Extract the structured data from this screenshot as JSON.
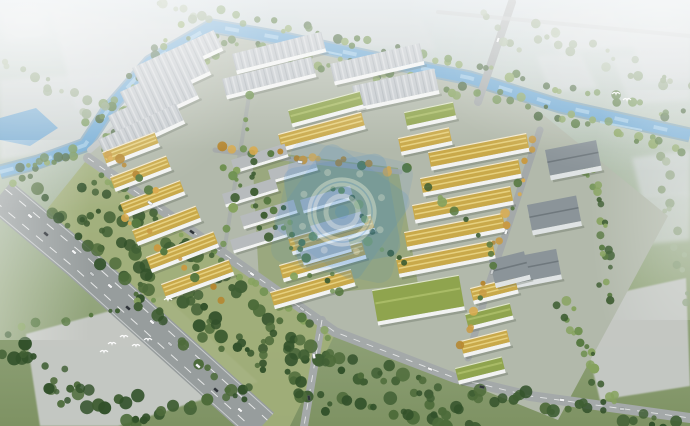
{
  "meta": {
    "description": "Bird's-eye architectural rendering of a large industrial park: rows of yellow-, green- and gray-roofed buildings bounded by tree-lined roads, a blue canal along the top, a wide highway at lower left, hazy vacant plots around the edges, flying birds, and a semi-transparent blue emblem watermark over the center."
  },
  "watermark": {
    "description": "semi-transparent blue circular emblem watermark",
    "color": "#2f7fd2",
    "light": "#d8e9f8",
    "cx": 342,
    "cy": 212,
    "rotate": -20,
    "opacity": 0.5
  },
  "palette": {
    "sky_top": "#ccd6db",
    "sky_mid": "#b2c0b0",
    "ground": "#8da272",
    "lawn": "#a2af7a",
    "park_base": "#b2b9ab",
    "villa_ground": "#9aa87e",
    "water": "#6ba6d1",
    "water_edge": "#4f86ae",
    "water_hi": "#a8d0ea",
    "road": "#a4a9a9",
    "road_light": "#bcc1c1",
    "highway": "#979d9d",
    "lane": "#eef0f0",
    "plot": "#d0d5d7",
    "pad": "#c7cac7",
    "wh_roof": "#c3c8cc",
    "wh_ridge": "#9aa2a8",
    "yl_roof": "#c9a94a",
    "yl_hi": "#e6d07f",
    "gr_roof": "#8fa44e",
    "gr_hi": "#a9bb66",
    "dk_roof": "#8b9499",
    "slab_roof": "#b7bbbd",
    "facade": "#f2f3f2",
    "facade_dk": "#dfe3e4",
    "shadow": "#4a5548",
    "bird": "#ffffff",
    "car_white": "#f4f5f5",
    "car_dark": "#2e3338",
    "car_gray": "#c9cdce",
    "tree_shades": {
      "mix": [
        "#3f5e33",
        "#567840",
        "#6f9150",
        "#86a25e"
      ],
      "dark": [
        "#32512a",
        "#3f5e33",
        "#4d6b3a"
      ],
      "autumn": [
        "#c89a43",
        "#b5862f",
        "#d9ab4f",
        "#567840"
      ],
      "hazy": [
        "#93a687",
        "#a3b496",
        "#8ba07c"
      ]
    }
  },
  "scene": {
    "plots": [
      {
        "p": [
          [
            52,
            10
          ],
          [
            222,
            30
          ],
          [
            252,
            94
          ],
          [
            76,
            110
          ]
        ],
        "o": 0.8,
        "soft": true
      },
      {
        "p": [
          [
            0,
            80
          ],
          [
            138,
            70
          ],
          [
            170,
            138
          ],
          [
            0,
            160
          ]
        ],
        "o": 0.75,
        "soft": true
      },
      {
        "p": [
          [
            0,
            8
          ],
          [
            36,
            4
          ],
          [
            50,
            36
          ],
          [
            6,
            42
          ]
        ],
        "o": 0.6,
        "soft": true
      },
      {
        "p": [
          [
            298,
            10
          ],
          [
            422,
            20
          ],
          [
            436,
            50
          ],
          [
            312,
            42
          ]
        ],
        "o": 0.55,
        "soft": true
      },
      {
        "p": [
          [
            532,
            14
          ],
          [
            610,
            10
          ],
          [
            638,
            46
          ],
          [
            558,
            52
          ]
        ],
        "o": 0.75,
        "soft": true
      },
      {
        "p": [
          [
            628,
            30
          ],
          [
            690,
            24
          ],
          [
            690,
            80
          ],
          [
            646,
            82
          ]
        ],
        "o": 0.7,
        "soft": true
      },
      {
        "p": [
          [
            536,
            56
          ],
          [
            580,
            53
          ],
          [
            598,
            88
          ],
          [
            550,
            91
          ]
        ],
        "o": 0.65,
        "soft": true
      },
      {
        "p": [
          [
            612,
            58
          ],
          [
            690,
            52
          ],
          [
            690,
            100
          ],
          [
            630,
            104
          ]
        ],
        "o": 0.6,
        "soft": true
      },
      {
        "p": [
          [
            632,
            158
          ],
          [
            690,
            150
          ],
          [
            690,
            196
          ],
          [
            642,
            200
          ]
        ],
        "o": 0.7,
        "soft": true
      },
      {
        "p": [
          [
            640,
            200
          ],
          [
            690,
            194
          ],
          [
            690,
            240
          ],
          [
            650,
            244
          ]
        ],
        "o": 0.6,
        "soft": true
      },
      {
        "p": [
          [
            576,
            302
          ],
          [
            686,
            278
          ],
          [
            690,
            386
          ],
          [
            600,
            400
          ]
        ],
        "o": 0.95,
        "pad": true
      },
      {
        "p": [
          [
            26,
            334
          ],
          [
            164,
            296
          ],
          [
            258,
            382
          ],
          [
            118,
            426
          ],
          [
            40,
            426
          ]
        ],
        "o": 0.95,
        "pad": true
      }
    ],
    "park": [
      [
        88,
        155
      ],
      [
        212,
        32
      ],
      [
        520,
        96
      ],
      [
        668,
        216
      ],
      [
        558,
        420
      ],
      [
        338,
        332
      ]
    ],
    "villa_zone": [
      [
        252,
        150
      ],
      [
        398,
        168
      ],
      [
        418,
        284
      ],
      [
        260,
        300
      ]
    ],
    "lawn": [
      [
        85,
        162
      ],
      [
        335,
        334
      ],
      [
        290,
        426
      ],
      [
        250,
        426
      ],
      [
        120,
        300
      ],
      [
        48,
        208
      ]
    ],
    "canal": {
      "d": "M0,172 L38,162 L85,145 L108,110 L150,62 L212,26 L280,38 L400,64 L470,78 L560,106 L690,135",
      "w": 11
    },
    "pond": [
      [
        0,
        118
      ],
      [
        36,
        108
      ],
      [
        58,
        128
      ],
      [
        30,
        146
      ],
      [
        0,
        140
      ]
    ],
    "sparkles": [
      [
        600,
        122,
        642,
        130
      ],
      [
        300,
        46,
        342,
        55
      ],
      [
        150,
        68,
        134,
        94
      ]
    ],
    "roads": [
      {
        "pts": [
          [
            90,
            150
          ],
          [
            218,
            38
          ]
        ],
        "w": 6,
        "c": "road_light"
      },
      {
        "pts": [
          [
            512,
            2
          ],
          [
            478,
            102
          ]
        ],
        "w": 8,
        "c": "road"
      },
      {
        "pts": [
          [
            438,
            12
          ],
          [
            690,
            36
          ]
        ],
        "w": 4,
        "c": "road_light",
        "o": 0.7
      },
      {
        "pts": [
          [
            88,
            158
          ],
          [
            335,
            332
          ],
          [
            455,
            378
          ],
          [
            530,
            396
          ],
          [
            690,
            418
          ]
        ],
        "w": 10,
        "c": "road",
        "dash": true
      },
      {
        "pts": [
          [
            322,
            320
          ],
          [
            304,
            426
          ]
        ],
        "w": 8,
        "c": "road",
        "dash": true
      },
      {
        "pts": [
          [
            540,
            130
          ],
          [
            487,
            290
          ],
          [
            468,
            358
          ]
        ],
        "w": 7,
        "c": "road"
      },
      {
        "pts": [
          [
            215,
            150
          ],
          [
            400,
            172
          ]
        ],
        "w": 5,
        "c": "road",
        "o": 0.9
      },
      {
        "pts": [
          [
            250,
            90
          ],
          [
            224,
            252
          ]
        ],
        "w": 4,
        "c": "road",
        "o": 0.7
      }
    ],
    "highway": {
      "pts": [
        [
          0,
          195
        ],
        [
          80,
          262
        ],
        [
          180,
          352
        ],
        [
          262,
          426
        ]
      ],
      "w": 36,
      "lanes": [
        [
          -5.4,
          5.9
        ],
        [
          5.4,
          -5.9
        ]
      ],
      "edges": [
        [
          -10.9,
          11.8
        ],
        [
          10.9,
          -11.8
        ]
      ]
    },
    "buildings": [
      [
        132,
        68,
        90,
        19,
        "wh",
        -25
      ],
      [
        120,
        92,
        90,
        19,
        "wh",
        -25
      ],
      [
        108,
        116,
        90,
        19,
        "wh",
        -25
      ],
      [
        98,
        140,
        86,
        18,
        "wh",
        -25
      ],
      [
        232,
        54,
        92,
        17,
        "wh",
        -14
      ],
      [
        222,
        79,
        92,
        17,
        "wh",
        -14
      ],
      [
        330,
        64,
        92,
        18,
        "wh",
        -13
      ],
      [
        352,
        86,
        84,
        22,
        "wh",
        -12
      ],
      [
        288,
        110,
        74,
        14,
        "gr",
        -15
      ],
      [
        278,
        134,
        86,
        14,
        "yl",
        -15
      ],
      [
        404,
        112,
        50,
        14,
        "gr",
        -12
      ],
      [
        398,
        138,
        52,
        14,
        "yl",
        -12
      ],
      [
        428,
        152,
        100,
        15,
        "yl",
        -11
      ],
      [
        420,
        178,
        100,
        15,
        "yl",
        -11
      ],
      [
        412,
        205,
        100,
        15,
        "yl",
        -11
      ],
      [
        404,
        232,
        100,
        15,
        "yl",
        -11
      ],
      [
        396,
        259,
        98,
        15,
        "yl",
        -11
      ],
      [
        545,
        150,
        52,
        26,
        "dk",
        -11
      ],
      [
        527,
        205,
        50,
        26,
        "dk",
        -11
      ],
      [
        509,
        258,
        48,
        26,
        "dk",
        -11
      ],
      [
        288,
        238,
        86,
        14,
        "yl",
        -16
      ],
      [
        279,
        265,
        86,
        14,
        "yl",
        -16
      ],
      [
        270,
        292,
        84,
        14,
        "yl",
        -16
      ],
      [
        372,
        290,
        88,
        32,
        "gr",
        -10
      ],
      [
        470,
        288,
        46,
        13,
        "yl",
        -14
      ],
      [
        465,
        314,
        46,
        13,
        "gr",
        -14
      ],
      [
        460,
        341,
        48,
        13,
        "yl",
        -14
      ],
      [
        455,
        368,
        48,
        13,
        "gr",
        -14
      ],
      [
        489,
        260,
        36,
        24,
        "dk",
        -14
      ],
      [
        102,
        152,
        56,
        12,
        "yl",
        -21
      ],
      [
        110,
        177,
        60,
        12,
        "yl",
        -21
      ],
      [
        120,
        203,
        64,
        12,
        "yl",
        -21
      ],
      [
        132,
        230,
        68,
        13,
        "yl",
        -21
      ],
      [
        146,
        257,
        72,
        13,
        "yl",
        -21
      ],
      [
        161,
        284,
        72,
        13,
        "yl",
        -20
      ],
      [
        231,
        160,
        56,
        11,
        "slab",
        -17
      ],
      [
        268,
        170,
        48,
        11,
        "slab",
        -16
      ],
      [
        222,
        194,
        55,
        11,
        "slab",
        -17
      ],
      [
        240,
        216,
        56,
        11,
        "slab",
        -17
      ],
      [
        230,
        240,
        56,
        11,
        "slab",
        -17
      ],
      [
        300,
        200,
        52,
        11,
        "slab",
        -16
      ],
      [
        310,
        226,
        53,
        11,
        "slab",
        -16
      ],
      [
        300,
        252,
        50,
        11,
        "slab",
        -16
      ]
    ],
    "belts_under": [
      [
        210,
        38,
        460,
        90,
        14,
        30,
        "mix"
      ],
      [
        460,
        90,
        690,
        148,
        16,
        26,
        "mix"
      ],
      [
        196,
        40,
        96,
        150,
        16,
        24,
        "mix"
      ],
      [
        222,
        14,
        470,
        66,
        12,
        24,
        "mix"
      ],
      [
        470,
        64,
        690,
        118,
        12,
        20,
        "mix"
      ],
      [
        180,
        28,
        90,
        128,
        12,
        16,
        "mix"
      ],
      [
        80,
        150,
        10,
        178,
        14,
        14,
        "mix"
      ],
      [
        100,
        158,
        220,
        48,
        8,
        14,
        "mix"
      ],
      [
        92,
        170,
        332,
        340,
        10,
        30,
        "mix"
      ],
      [
        80,
        180,
        320,
        352,
        14,
        30,
        "dark"
      ],
      [
        70,
        210,
        300,
        390,
        30,
        55,
        "dark"
      ],
      [
        10,
        165,
        250,
        408,
        10,
        26,
        "dark"
      ],
      [
        0,
        350,
        150,
        426,
        34,
        34,
        "dark"
      ],
      [
        20,
        330,
        170,
        298,
        8,
        10,
        "mix"
      ],
      [
        120,
        420,
        260,
        386,
        10,
        12,
        "dark"
      ],
      [
        255,
        335,
        470,
        408,
        26,
        44,
        "dark"
      ],
      [
        300,
        400,
        480,
        426,
        16,
        20,
        "dark"
      ],
      [
        470,
        390,
        690,
        424,
        18,
        26,
        "dark"
      ],
      [
        560,
        300,
        610,
        400,
        16,
        20,
        "mix"
      ],
      [
        588,
        160,
        610,
        300,
        18,
        22,
        "mix"
      ],
      [
        660,
        150,
        688,
        300,
        12,
        14,
        "hazy"
      ],
      [
        0,
        66,
        150,
        134,
        20,
        18,
        "hazy"
      ],
      [
        150,
        6,
        215,
        20,
        10,
        8,
        "hazy"
      ],
      [
        520,
        26,
        690,
        92,
        24,
        20,
        "hazy"
      ],
      [
        480,
        8,
        520,
        60,
        10,
        6,
        "hazy"
      ]
    ],
    "belts_over": [
      [
        536,
        134,
        462,
        350,
        8,
        20,
        "autumn"
      ],
      [
        218,
        146,
        398,
        170,
        7,
        16,
        "autumn"
      ],
      [
        250,
        92,
        224,
        252,
        6,
        10,
        "mix"
      ],
      [
        228,
        160,
        330,
        285,
        34,
        30,
        "mix"
      ],
      [
        330,
        180,
        400,
        270,
        20,
        12,
        "mix"
      ],
      [
        118,
        210,
        225,
        300,
        9,
        12,
        "autumn"
      ],
      [
        100,
        150,
        160,
        195,
        8,
        8,
        "autumn"
      ],
      [
        404,
        166,
        500,
        250,
        6,
        8,
        "mix"
      ]
    ],
    "cars": [
      [
        30,
        216,
        41,
        "car_white"
      ],
      [
        46,
        234,
        41,
        "car_dark"
      ],
      [
        74,
        252,
        41,
        "car_white"
      ],
      [
        92,
        274,
        41,
        "car_gray"
      ],
      [
        110,
        286,
        41,
        "car_white"
      ],
      [
        128,
        308,
        41,
        "car_dark"
      ],
      [
        152,
        322,
        41,
        "car_white"
      ],
      [
        170,
        344,
        41,
        "car_gray"
      ],
      [
        198,
        366,
        41,
        "car_white"
      ],
      [
        216,
        390,
        41,
        "car_dark"
      ],
      [
        240,
        410,
        41,
        "car_white"
      ],
      [
        150,
        203,
        35,
        "car_white"
      ],
      [
        192,
        232,
        35,
        "car_dark"
      ],
      [
        252,
        274,
        35,
        "car_white"
      ],
      [
        302,
        309,
        35,
        "car_gray"
      ],
      [
        430,
        369,
        22,
        "car_white"
      ],
      [
        482,
        387,
        12,
        "car_dark"
      ],
      [
        562,
        400,
        7,
        "car_white"
      ],
      [
        622,
        409,
        6,
        "car_gray"
      ],
      [
        314,
        356,
        80,
        "car_white"
      ],
      [
        309,
        398,
        80,
        "car_dark"
      ],
      [
        506,
        232,
        108,
        "car_white"
      ],
      [
        492,
        272,
        108,
        "car_gray"
      ],
      [
        498,
        40,
        109,
        "car_white"
      ],
      [
        300,
        162,
        8,
        "car_white"
      ]
    ],
    "birds": [
      [
        112,
        344
      ],
      [
        124,
        337
      ],
      [
        136,
        346
      ],
      [
        104,
        352
      ],
      [
        148,
        340
      ],
      [
        616,
        94
      ],
      [
        627,
        100
      ],
      [
        168,
        300
      ]
    ]
  }
}
